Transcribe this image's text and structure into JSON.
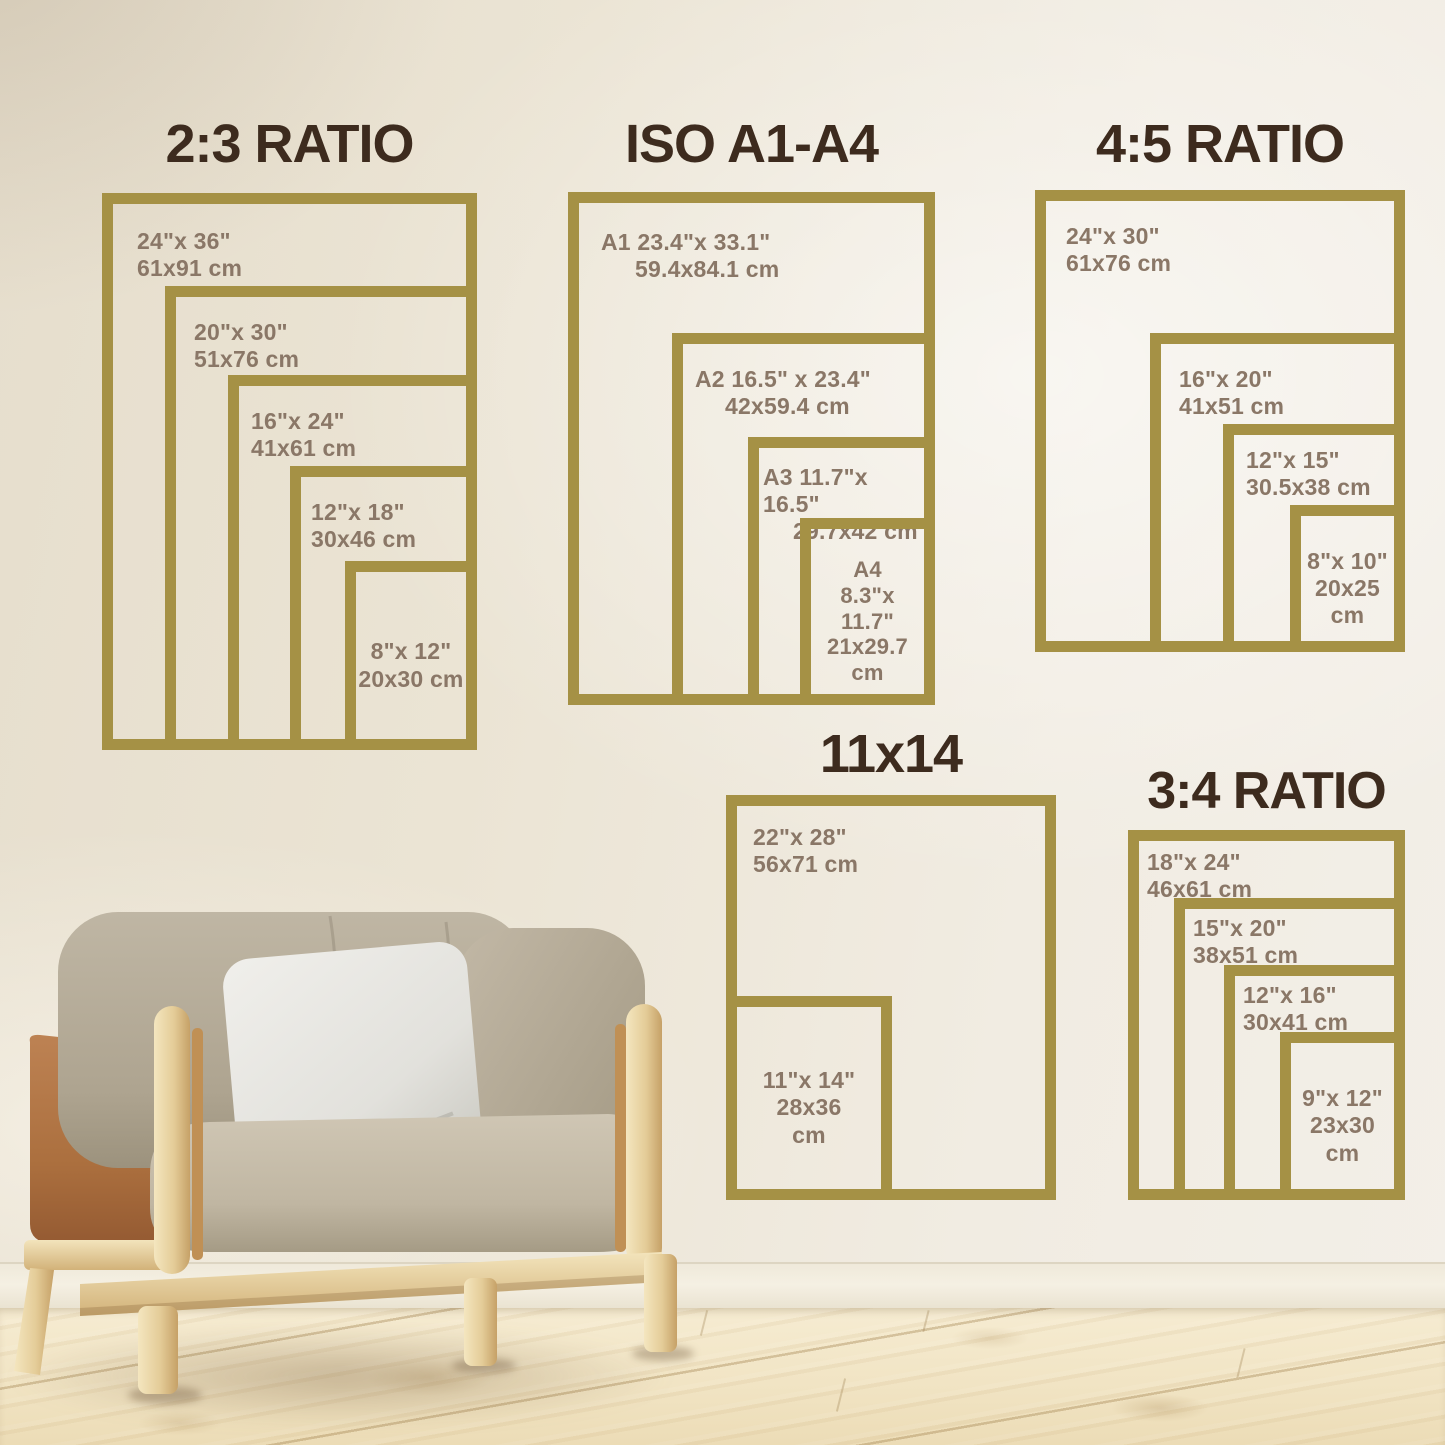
{
  "colors": {
    "frame_gold": "#a59145",
    "title_brown": "#3d2b1e",
    "label_taupe": "#8a7767"
  },
  "sections": [
    {
      "id": "2-3-ratio",
      "title": "2:3 RATIO",
      "frames": [
        {
          "name": "24x36",
          "label": "24\"x 36\"\n61x91 cm"
        },
        {
          "name": "20x30",
          "label": "20\"x 30\"\n51x76 cm"
        },
        {
          "name": "16x24",
          "label": "16\"x 24\"\n41x61 cm"
        },
        {
          "name": "12x18",
          "label": "12\"x 18\"\n30x46 cm"
        },
        {
          "name": "8x12",
          "label": "8\"x 12\"\n20x30 cm"
        }
      ]
    },
    {
      "id": "iso-a1-a4",
      "title": "ISO A1-A4",
      "frames": [
        {
          "name": "A1",
          "line1": "A1 23.4\"x 33.1\"",
          "line2": "59.4x84.1 cm"
        },
        {
          "name": "A2",
          "line1": "A2 16.5\" x 23.4\"",
          "line2": "42x59.4 cm"
        },
        {
          "name": "A3",
          "line1": "A3 11.7\"x 16.5\"",
          "line2": "29.7x42 cm"
        },
        {
          "name": "A4",
          "label": "A4\n8.3\"x 11.7\"\n21x29.7\ncm"
        }
      ]
    },
    {
      "id": "4-5-ratio",
      "title": "4:5 RATIO",
      "frames": [
        {
          "name": "24x30",
          "label": "24\"x 30\"\n61x76 cm"
        },
        {
          "name": "16x20",
          "label": "16\"x 20\"\n41x51 cm"
        },
        {
          "name": "12x15",
          "label": "12\"x 15\"\n30.5x38 cm"
        },
        {
          "name": "8x10",
          "label": "8\"x 10\"\n20x25\ncm"
        }
      ]
    },
    {
      "id": "11x14",
      "title": "11x14",
      "frames": [
        {
          "name": "22x28",
          "label": "22\"x 28\"\n56x71 cm"
        },
        {
          "name": "11x14",
          "label": "11\"x 14\"\n28x36\ncm"
        }
      ]
    },
    {
      "id": "3-4-ratio",
      "title": "3:4 RATIO",
      "frames": [
        {
          "name": "18x24",
          "label": "18\"x 24\"\n46x61 cm"
        },
        {
          "name": "15x20",
          "label": "15\"x 20\"\n38x51 cm"
        },
        {
          "name": "12x16",
          "label": "12\"x 16\"\n30x41 cm"
        },
        {
          "name": "9x12",
          "label": "9\"x 12\"\n23x30\ncm"
        }
      ]
    }
  ]
}
